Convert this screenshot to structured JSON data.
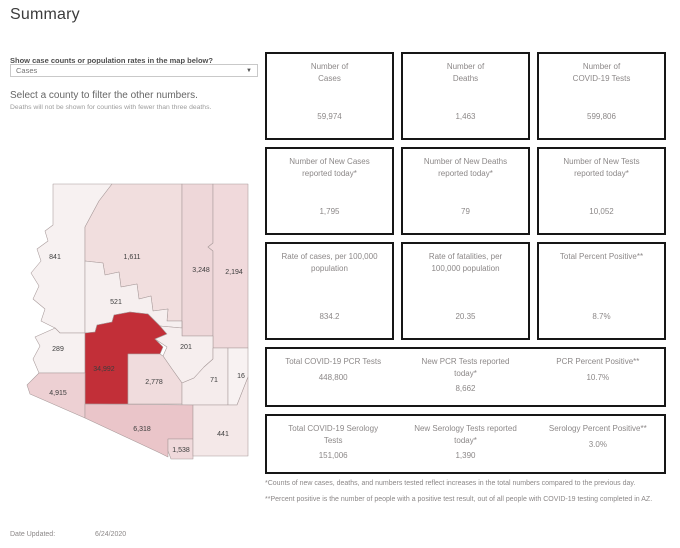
{
  "title": "Summary",
  "controls": {
    "question_label": "Show case counts or population rates in the map below?",
    "dropdown_value": "Cases",
    "caret": "▼",
    "filter_hint": "Select a county to filter the other numbers.",
    "deaths_note": "Deaths will not be shown for counties with fewer than three deaths."
  },
  "map": {
    "counties": [
      {
        "id": "mohave",
        "value": "841",
        "color": "#f7f1f1"
      },
      {
        "id": "coconino",
        "value": "1,611",
        "color": "#f1dede"
      },
      {
        "id": "navajo",
        "value": "3,248",
        "color": "#eed7d9"
      },
      {
        "id": "apache",
        "value": "2,194",
        "color": "#f0d9db"
      },
      {
        "id": "yavapai",
        "value": "521",
        "color": "#f6efef"
      },
      {
        "id": "la-paz",
        "value": "289",
        "color": "#f7f1f1"
      },
      {
        "id": "maricopa",
        "value": "34,992",
        "color": "#c22f38"
      },
      {
        "id": "gila",
        "value": "201",
        "color": "#f6eeee"
      },
      {
        "id": "pinal",
        "value": "2,778",
        "color": "#f0dcdd"
      },
      {
        "id": "graham",
        "value": "71",
        "color": "#f5ecec"
      },
      {
        "id": "greenlee",
        "value": "16",
        "color": "#f8f2f2"
      },
      {
        "id": "yuma",
        "value": "4,915",
        "color": "#edd0d3"
      },
      {
        "id": "pima",
        "value": "6,318",
        "color": "#eac5c9"
      },
      {
        "id": "santa-cruz",
        "value": "1,538",
        "color": "#f0d9db"
      },
      {
        "id": "cochise",
        "value": "441",
        "color": "#f4e8e8"
      }
    ]
  },
  "stats": {
    "cards": [
      {
        "title": "Number of\nCases",
        "value": "59,974"
      },
      {
        "title": "Number of\nDeaths",
        "value": "1,463"
      },
      {
        "title": "Number of\nCOVID-19 Tests",
        "value": "599,806"
      },
      {
        "title": "Number of New Cases\nreported today*",
        "value": "1,795"
      },
      {
        "title": "Number of New Deaths\nreported today*",
        "value": "79"
      },
      {
        "title": "Number of New Tests\nreported today*",
        "value": "10,052"
      },
      {
        "title": "Rate of cases, per 100,000\npopulation",
        "value": "834.2"
      },
      {
        "title": "Rate of fatalities, per\n100,000 population",
        "value": "20.35"
      },
      {
        "title": "Total Percent Positive**",
        "value": "8.7%"
      }
    ],
    "pcr_row": [
      {
        "title": "Total COVID-19 PCR Tests",
        "value": "448,800"
      },
      {
        "title": "New PCR Tests reported\ntoday*",
        "value": "8,662"
      },
      {
        "title": "PCR Percent Positive**",
        "value": "10.7%"
      }
    ],
    "serology_row": [
      {
        "title": "Total COVID-19 Serology\nTests",
        "value": "151,006"
      },
      {
        "title": "New Serology Tests reported\ntoday*",
        "value": "1,390"
      },
      {
        "title": "Serology Percent Positive**",
        "value": "3.0%"
      }
    ]
  },
  "footnotes": [
    "*Counts of new cases, deaths, and numbers tested reflect increases in the total numbers compared to the previous day.",
    "**Percent positive is the number of people with a positive test result, out of all people with COVID-19 testing completed in AZ."
  ],
  "footer": {
    "date_label": "Date Updated:",
    "date_value": "6/24/2020"
  }
}
